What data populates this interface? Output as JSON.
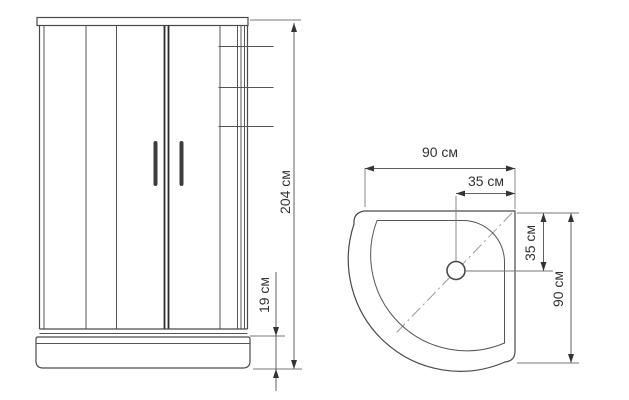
{
  "front_view": {
    "dimensions": {
      "total_height": "204 см",
      "base_height": "19 см"
    }
  },
  "top_view": {
    "dimensions": {
      "width": "90 см",
      "drain_offset_horizontal": "35 см",
      "drain_offset_vertical": "35 см",
      "depth": "90 см"
    }
  },
  "colors": {
    "line": "#4a4a4a",
    "dimension": "#606060",
    "text": "#333333",
    "background": "#ffffff"
  }
}
